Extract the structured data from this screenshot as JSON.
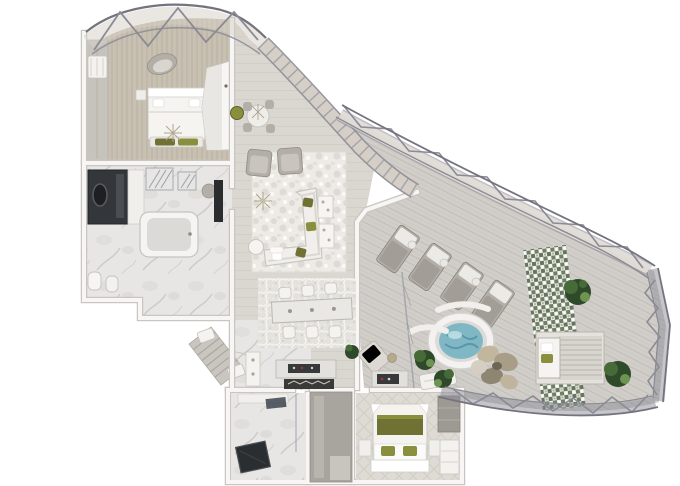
{
  "page": {
    "kind": "3d-floorplan-render",
    "background": "#ffffff",
    "canvas": {
      "width": 680,
      "height": 486
    }
  },
  "palette": {
    "white_bg": "#ffffff",
    "wall": "#f7f6f4",
    "wall_edge": "#c9c6c1",
    "glass_tint": "#d8d2c7",
    "frame": "#8b8b95",
    "frame_dark": "#74747e",
    "deck": "#d1cec9",
    "deck_line": "#c0bdb8",
    "floor_wood": "#dad6d0",
    "floor_line": "#cfcbc5",
    "carpet_tan": "#c8c0b1",
    "marble": "#e7e6e4",
    "marble_vein": "#c0bebb",
    "rug_light": "#edebe6",
    "rug_mid": "#d7d4cd",
    "sofa": "#f1efeb",
    "gray_furn": "#b3afa8",
    "gray_dark": "#8f8b84",
    "olive": "#6f7233",
    "olive_bright": "#8a8f3e",
    "plant_dark": "#2f4a2b",
    "plant_mid": "#476b38",
    "plant_light": "#6d9450",
    "water": "#7fb7c4",
    "water_deep": "#548ea0",
    "tile_green": "#6b7a5e",
    "tile_deep": "#49583f",
    "dark": "#2a2c2e",
    "tan_accent": "#b7a98e",
    "red_accent": "#a33c2f"
  },
  "scene": {
    "type": "penthouse-suite-top-down-render",
    "rooms": [
      {
        "id": "master-bedroom",
        "features": [
          "bed-with-olive-cushions",
          "wardrobe",
          "curved-armchair",
          "closet-pod"
        ]
      },
      {
        "id": "master-bathroom",
        "features": [
          "dark-vanity-porthole",
          "bathtub",
          "shower-screens",
          "toilet",
          "bidet"
        ]
      },
      {
        "id": "living-room",
        "features": [
          "sectional-sofa",
          "two-armchairs",
          "organic-rug",
          "coffee-table",
          "wall-tv",
          "breakfast-nook",
          "sputnik-chandelier"
        ]
      },
      {
        "id": "dining-area",
        "features": [
          "dining-table",
          "six-chairs",
          "patterned-rug",
          "sideboard",
          "dark-runner"
        ]
      },
      {
        "id": "foyer",
        "features": [
          "entry-door",
          "exterior-stairs",
          "step-stools"
        ]
      },
      {
        "id": "second-bathroom",
        "features": [
          "marble-floor",
          "dark-shower-mat",
          "glass-screen"
        ]
      },
      {
        "id": "second-bedroom",
        "features": [
          "bed-olive-throw",
          "nightstands",
          "closet",
          "dresser"
        ]
      },
      {
        "id": "terrace",
        "features": [
          "four-sun-loungers",
          "jacuzzi",
          "rock-seating",
          "cabana-daybed",
          "green-mosaic-band",
          "planters",
          "outdoor-lounge-set",
          "truss-railing"
        ]
      }
    ],
    "structure": [
      "curved-glass-facade",
      "triangular-truss-band",
      "terrace-perimeter-railing"
    ]
  }
}
